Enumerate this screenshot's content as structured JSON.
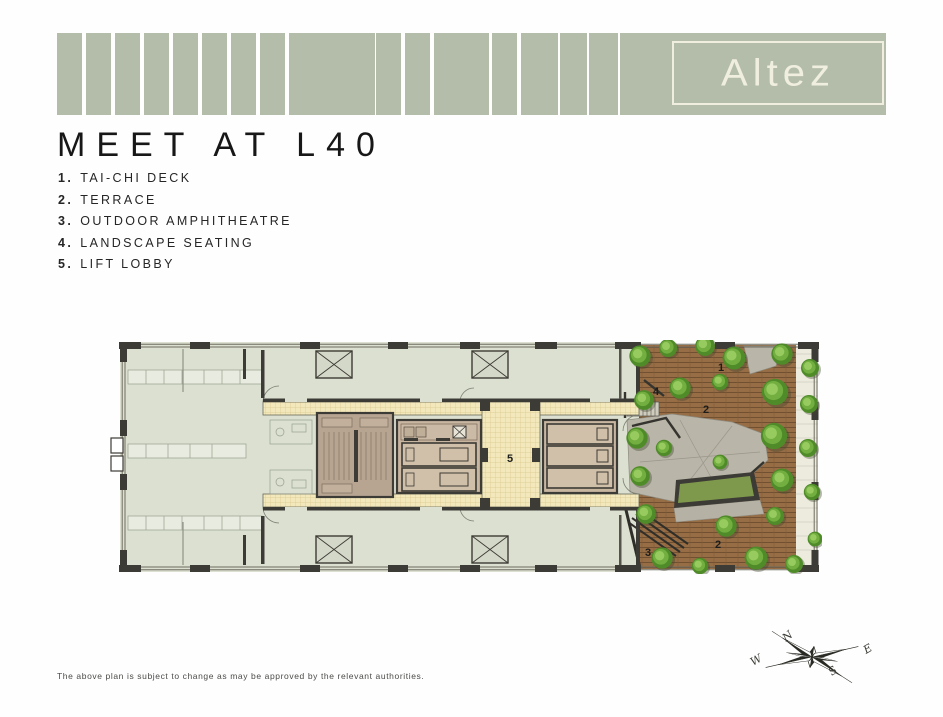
{
  "brand": {
    "logo_text": "Altez"
  },
  "title": "MEET AT L40",
  "legend": {
    "items": [
      {
        "number": "1.",
        "label": "TAI-CHI DECK"
      },
      {
        "number": "2.",
        "label": "TERRACE"
      },
      {
        "number": "3.",
        "label": "OUTDOOR AMPHITHEATRE"
      },
      {
        "number": "4.",
        "label": "LANDSCAPE SEATING"
      },
      {
        "number": "5.",
        "label": "LIFT LOBBY"
      }
    ]
  },
  "floor_plan": {
    "markers": {
      "tai_chi_deck": "1",
      "landscape_seating": "4",
      "terrace_upper": "2",
      "lift_lobby": "5",
      "outdoor_amphitheatre": "3",
      "terrace_lower": "2"
    }
  },
  "compass": {
    "north": "N",
    "east": "E",
    "south": "S",
    "west": "W"
  },
  "disclaimer": "The above plan is subject to change as may be approved by the relevant authorities.",
  "colors": {
    "banner_sage": "#b4bdaa",
    "logo_cream": "#f0eedf",
    "wall": "#3d3b35",
    "room": "#dce0d1",
    "corridor": "#f3e8bc",
    "lift_core": "#c8b6a1",
    "deck_wood": "#976d45",
    "tree_green": "#4f8c29",
    "plaza_gray": "#b9b5a8"
  }
}
